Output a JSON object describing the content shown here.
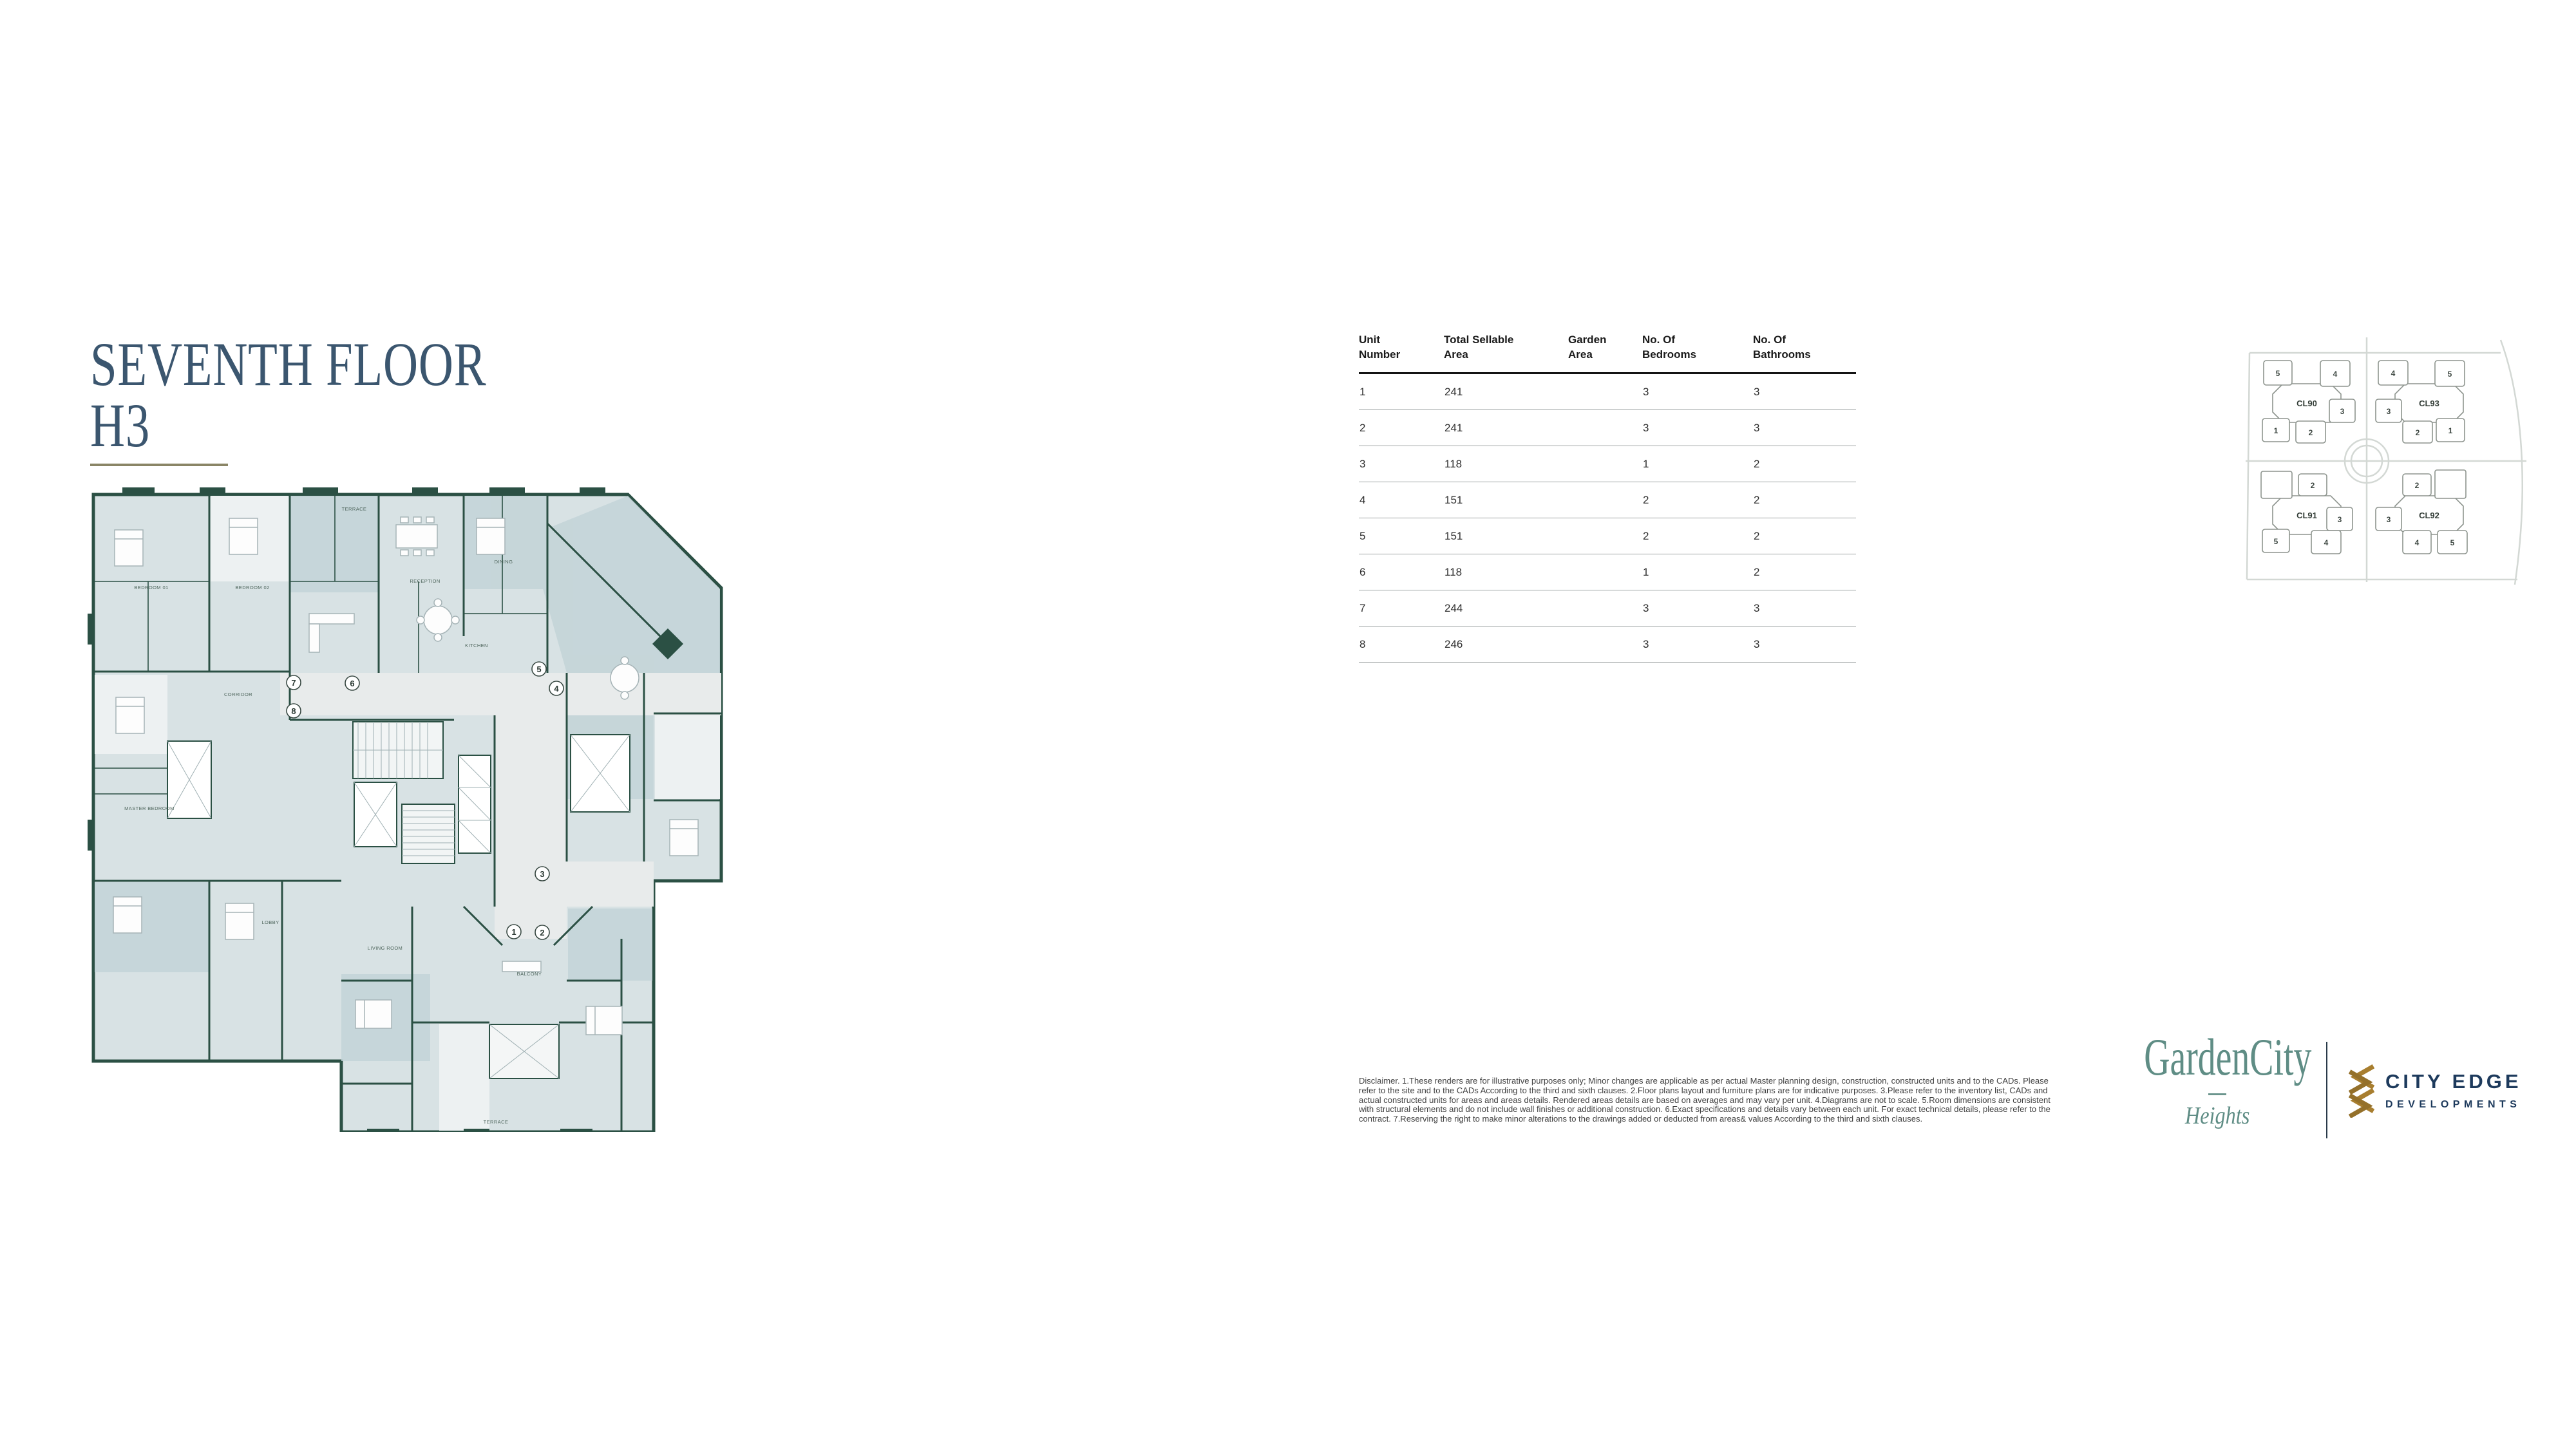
{
  "title": {
    "line1": "SEVENTH FLOOR",
    "line2": "H3"
  },
  "colors": {
    "title_text": "#3b566f",
    "title_underline": "#8a8566",
    "plan_wall": "#2b5044",
    "plan_fill": "#d8e2e4",
    "plan_dark_zone": "#c3d4d8",
    "plan_corridor": "#e8ebeb",
    "map_highlight": "#2b463b",
    "logo_teal": "#5f8d85",
    "logo_navy": "#1d3a5c",
    "logo_gold": "#a87e2f"
  },
  "floorplan": {
    "markers": [
      "1",
      "2",
      "3",
      "4",
      "5",
      "6",
      "7",
      "8"
    ],
    "room_labels": [
      "TERRACE",
      "BEDROOM 01",
      "BEDROOM 02",
      "MASTER BEDROOM",
      "RECEPTION",
      "DINING",
      "KITCHEN",
      "LIVING ROOM",
      "CORRIDOR",
      "LOBBY",
      "BALCONY",
      "TERRACE"
    ]
  },
  "table": {
    "headers": [
      "Unit\nNumber",
      "Total Sellable\nArea",
      "Garden\nArea",
      "No. Of\nBedrooms",
      "No. Of\nBathrooms"
    ],
    "rows": [
      {
        "unit": "1",
        "sellable": "241",
        "garden": "",
        "bedrooms": "3",
        "bathrooms": "3"
      },
      {
        "unit": "2",
        "sellable": "241",
        "garden": "",
        "bedrooms": "3",
        "bathrooms": "3"
      },
      {
        "unit": "3",
        "sellable": "118",
        "garden": "",
        "bedrooms": "1",
        "bathrooms": "2"
      },
      {
        "unit": "4",
        "sellable": "151",
        "garden": "",
        "bedrooms": "2",
        "bathrooms": "2"
      },
      {
        "unit": "5",
        "sellable": "151",
        "garden": "",
        "bedrooms": "2",
        "bathrooms": "2"
      },
      {
        "unit": "6",
        "sellable": "118",
        "garden": "",
        "bedrooms": "1",
        "bathrooms": "2"
      },
      {
        "unit": "7",
        "sellable": "244",
        "garden": "",
        "bedrooms": "3",
        "bathrooms": "3"
      },
      {
        "unit": "8",
        "sellable": "246",
        "garden": "",
        "bedrooms": "3",
        "bathrooms": "3"
      }
    ]
  },
  "sitemap": {
    "clusters": [
      {
        "label": "CL90",
        "blocks": [
          {
            "num": "5"
          },
          {
            "num": "4"
          },
          {
            "num": "3"
          },
          {
            "num": "1"
          },
          {
            "num": "2"
          }
        ]
      },
      {
        "label": "CL93",
        "blocks": [
          {
            "num": "4"
          },
          {
            "num": "5"
          },
          {
            "num": "3"
          },
          {
            "num": "2"
          },
          {
            "num": "1"
          }
        ]
      },
      {
        "label": "CL91",
        "blocks": [
          {
            "num": "1",
            "highlighted": true
          },
          {
            "num": "2"
          },
          {
            "num": "3"
          },
          {
            "num": "5"
          },
          {
            "num": "4"
          }
        ]
      },
      {
        "label": "CL92",
        "blocks": [
          {
            "num": "2"
          },
          {
            "num": "1",
            "highlighted": true
          },
          {
            "num": "3"
          },
          {
            "num": "4"
          },
          {
            "num": "5"
          }
        ]
      }
    ]
  },
  "disclaimer": {
    "text": "Disclaimer. 1.These renders are for illustrative purposes only; Minor changes are applicable as per actual Master planning design, construction, constructed units and to the CADs. Please refer to the site and to the CADs According to the third and sixth clauses. 2.Floor plans layout and furniture plans are for indicative purposes. 3.Please refer to the inventory list, CADs and actual constructed units for areas and areas details. Rendered areas details are based on averages and may vary per unit. 4.Diagrams are not to scale. 5.Room dimensions are consistent with structural elements and do not include wall finishes or additional construction. 6.Exact specifications and details vary between each unit. For exact technical details, please refer to the contract. 7.Reserving the right to make minor alterations to the drawings added or deducted from areas& values According to the third and sixth clauses."
  },
  "footer": {
    "gardencity": {
      "name": "GardenCity",
      "sub": "Heights"
    },
    "cityedge": {
      "line1": "CITY EDGE",
      "line2": "DEVELOPMENTS"
    }
  }
}
